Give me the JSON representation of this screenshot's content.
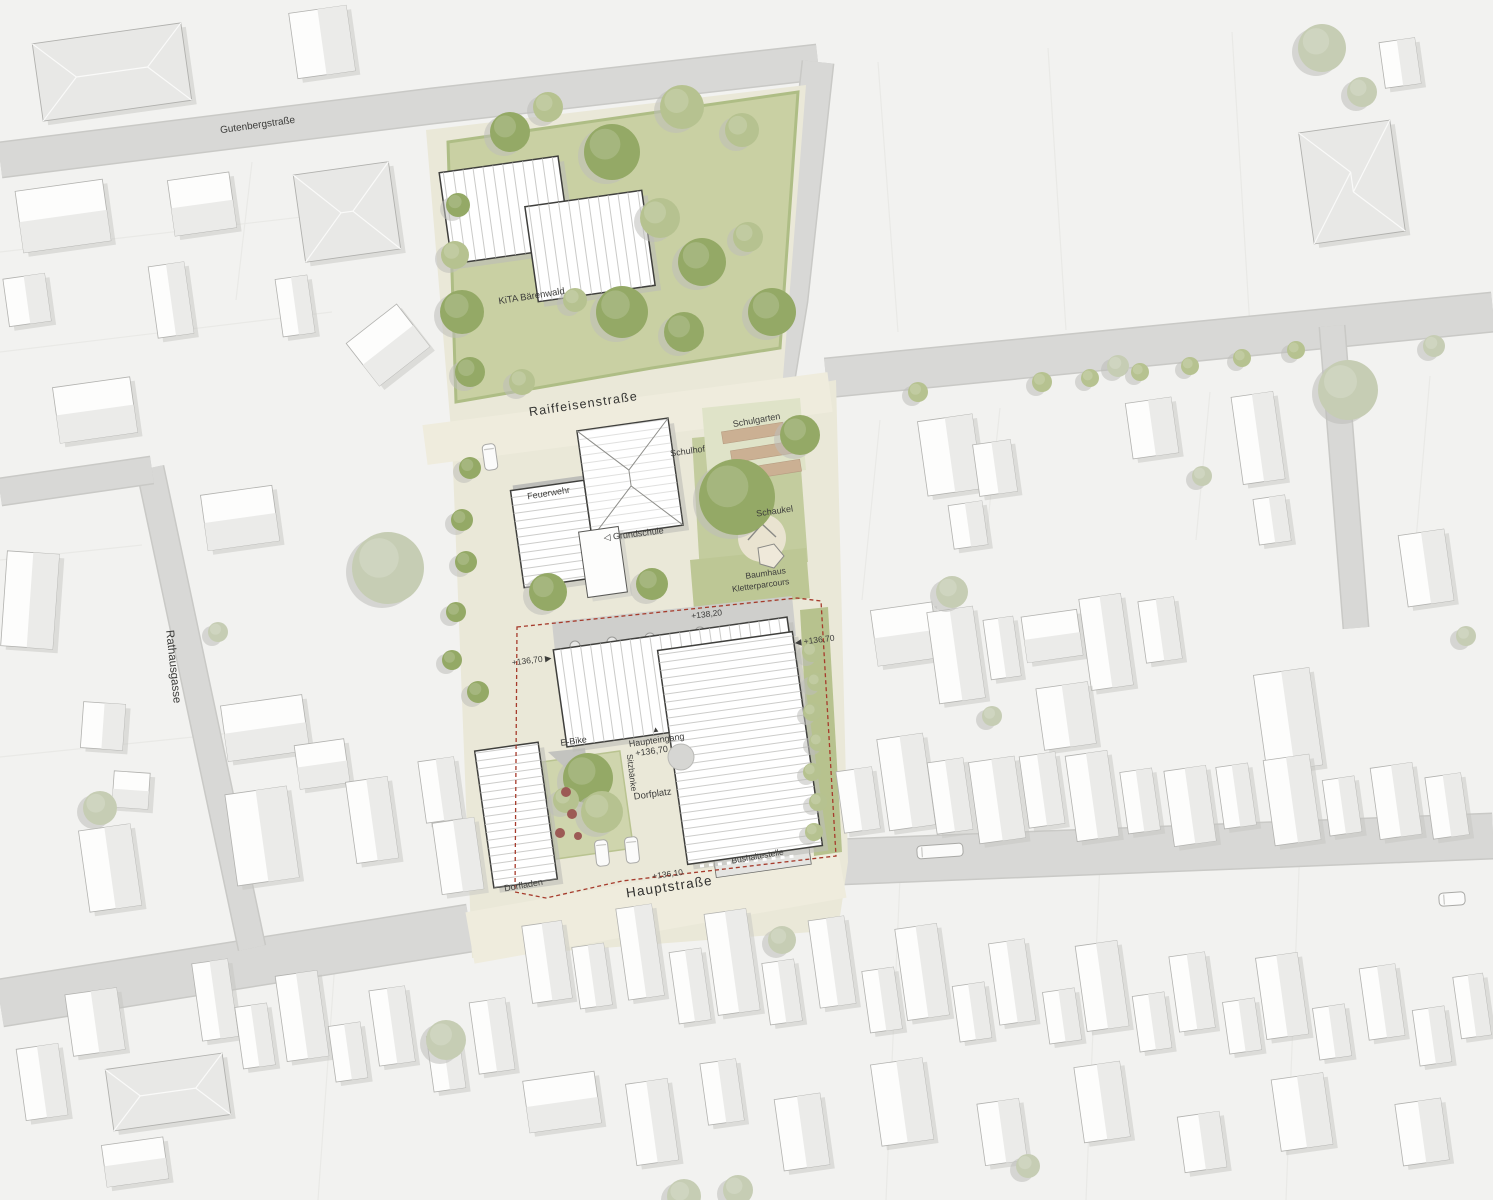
{
  "map": {
    "streets": {
      "gutenbergstrasse": "Gutenbergstraße",
      "raiffeisenstrasse": "Raiffeisenstraße",
      "hauptstrasse": "Hauptstraße",
      "rathausgasse": "Rathausgasse"
    },
    "facilities": {
      "kita": "KiTA Bärenwald",
      "feuerwehr": "Feuerwehr",
      "grundschule": "◁ Grundschule",
      "schulhof": "Schulhof",
      "schulgarten": "Schulgarten",
      "schaukel": "Schaukel",
      "baumhaus": "Baumhaus",
      "kletterparcours": "Kletterparcours",
      "dorfplatz": "Dorfplatz",
      "dorfladen": "Dorfladen",
      "bushaltestelle": "Bushaltestelle",
      "ebike": "E-Bike",
      "sitzbaenke": "Sitzbänke",
      "haupteingang": "Haupteingang",
      "haupteingang_marker": "▲"
    },
    "levels": {
      "l13820": "+138,20",
      "l13670_east": "◀ +136,70",
      "l13670_west": "+136,70 ▶",
      "l13670_entry": "+136,70",
      "l13610": "+136,10"
    },
    "colors": {
      "background": "#f2f2f0",
      "street": "#d8d8d6",
      "site_paving": "#eae8d8",
      "lawn": "#c9d0a3",
      "tree_dark": "#94a966",
      "tree_light": "#b6c290",
      "tree_gray": "#c6cdb4",
      "building_fill": "#fdfdfc",
      "project_outline": "#3f3f3c",
      "boundary_red": "#a63b2c"
    }
  }
}
